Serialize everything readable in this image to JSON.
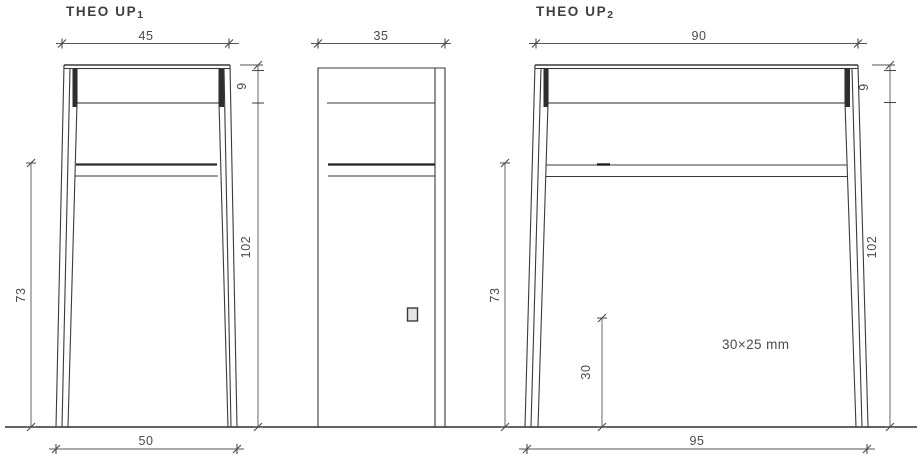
{
  "colors": {
    "background": "#ffffff",
    "drawing_line": "#3a3a3a",
    "dimension_line": "#565656",
    "label_text": "#4a4a4a",
    "dark_leg_shading": "#2e2e2e",
    "socket_fill": "#e4e4e4"
  },
  "theo_up1": {
    "title": "THEO UP",
    "title_sub": "1",
    "dim_top_width": "45",
    "dim_top_thickness": "9",
    "dim_height_total": "102",
    "dim_height_under_shelf": "73",
    "dim_base_width": "50"
  },
  "side_view": {
    "dim_depth": "35"
  },
  "theo_up2": {
    "title": "THEO UP",
    "title_sub": "2",
    "dim_top_width": "90",
    "dim_top_thickness": "9",
    "dim_height_total": "102",
    "dim_height_under_shelf": "73",
    "dim_shelf_support_height": "30",
    "dim_base_width": "95",
    "note_profile": "30×25 mm"
  }
}
